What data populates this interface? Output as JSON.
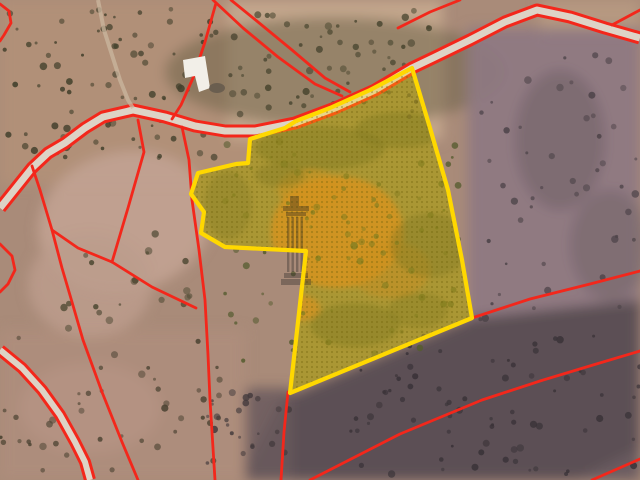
{
  "map": {
    "kind": "satellite-cadastral-map",
    "colors": {
      "parcel_stroke": "#ffd800",
      "parcel_fill": "rgba(255,214,0,0.30)",
      "parcel_dot_texture": "rgba(110,100,10,0.38)",
      "boundary_red": "#f3271b",
      "road_fill": "#ddd3c6",
      "dirt_orange": "#c1762e",
      "terrain_base": "#a98b79",
      "building_white": "#f2efe8"
    },
    "selected_parcel": {
      "points": [
        [
          412,
          68
        ],
        [
          370,
          90
        ],
        [
          330,
          108
        ],
        [
          296,
          121
        ],
        [
          285,
          128
        ],
        [
          250,
          139
        ],
        [
          248,
          163
        ],
        [
          236,
          164
        ],
        [
          198,
          173
        ],
        [
          191,
          194
        ],
        [
          204,
          212
        ],
        [
          201,
          233
        ],
        [
          225,
          247
        ],
        [
          306,
          251
        ],
        [
          290,
          393
        ],
        [
          472,
          318
        ],
        [
          462,
          260
        ],
        [
          448,
          190
        ],
        [
          430,
          128
        ]
      ]
    },
    "boundaries": [
      {
        "points": [
          [
            0,
            4
          ],
          [
            9,
            11
          ],
          [
            11,
            23
          ],
          [
            4,
            35
          ],
          [
            0,
            41
          ]
        ]
      },
      {
        "points": [
          [
            213,
            0
          ],
          [
            243,
            28
          ],
          [
            278,
            57
          ],
          [
            315,
            84
          ],
          [
            342,
            96
          ]
        ]
      },
      {
        "points": [
          [
            231,
            0
          ],
          [
            258,
            22
          ],
          [
            292,
            50
          ],
          [
            325,
            78
          ],
          [
            350,
            92
          ]
        ]
      },
      {
        "points": [
          [
            216,
            3
          ],
          [
            205,
            42
          ],
          [
            193,
            78
          ],
          [
            181,
            105
          ],
          [
            172,
            119
          ]
        ]
      },
      {
        "points": [
          [
            398,
            28
          ],
          [
            430,
            12
          ],
          [
            460,
            0
          ]
        ]
      },
      {
        "points": [
          [
            612,
            25
          ],
          [
            640,
            10
          ]
        ]
      },
      {
        "points": [
          [
            138,
            120
          ],
          [
            144,
            152
          ],
          [
            128,
            208
          ],
          [
            112,
            262
          ]
        ]
      },
      {
        "points": [
          [
            32,
            166
          ],
          [
            40,
            190
          ],
          [
            52,
            230
          ],
          [
            78,
            248
          ],
          [
            112,
            262
          ]
        ]
      },
      {
        "points": [
          [
            52,
            230
          ],
          [
            62,
            268
          ],
          [
            72,
            302
          ],
          [
            83,
            340
          ],
          [
            102,
            392
          ],
          [
            122,
            442
          ],
          [
            138,
            480
          ]
        ]
      },
      {
        "points": [
          [
            112,
            262
          ],
          [
            152,
            287
          ],
          [
            196,
            308
          ]
        ]
      },
      {
        "points": [
          [
            182,
            127
          ],
          [
            189,
            160
          ],
          [
            192,
            200
          ],
          [
            199,
            250
          ],
          [
            205,
            300
          ],
          [
            208,
            355
          ],
          [
            210,
            400
          ],
          [
            215,
            480
          ]
        ]
      },
      {
        "points": [
          [
            288,
            392
          ],
          [
            284,
            432
          ],
          [
            281,
            480
          ]
        ]
      },
      {
        "points": [
          [
            472,
            318
          ],
          [
            530,
            299
          ],
          [
            590,
            284
          ],
          [
            640,
            271
          ]
        ]
      },
      {
        "points": [
          [
            310,
            480
          ],
          [
            400,
            434
          ],
          [
            482,
            400
          ],
          [
            540,
            381
          ],
          [
            593,
            365
          ],
          [
            640,
            351
          ]
        ]
      },
      {
        "points": [
          [
            592,
            480
          ],
          [
            640,
            459
          ]
        ]
      },
      {
        "points": [
          [
            0,
            244
          ],
          [
            12,
            256
          ],
          [
            15,
            270
          ],
          [
            8,
            284
          ],
          [
            0,
            292
          ]
        ]
      }
    ],
    "roads": [
      {
        "width": 7,
        "points": [
          [
            0,
            208
          ],
          [
            8,
            198
          ],
          [
            20,
            183
          ],
          [
            32,
            168
          ],
          [
            48,
            153
          ],
          [
            65,
            143
          ],
          [
            85,
            128
          ],
          [
            103,
            117
          ],
          [
            133,
            110
          ],
          [
            165,
            117
          ],
          [
            195,
            126
          ],
          [
            225,
            131
          ],
          [
            255,
            131
          ],
          [
            295,
            123
          ],
          [
            335,
            108
          ],
          [
            375,
            90
          ],
          [
            412,
            68
          ],
          [
            435,
            57
          ],
          [
            470,
            40
          ],
          [
            505,
            22
          ],
          [
            537,
            10
          ],
          [
            570,
            17
          ],
          [
            605,
            28
          ],
          [
            640,
            38
          ]
        ]
      },
      {
        "width": 6,
        "points": [
          [
            0,
            350
          ],
          [
            22,
            368
          ],
          [
            42,
            390
          ],
          [
            60,
            415
          ],
          [
            75,
            442
          ],
          [
            85,
            462
          ],
          [
            90,
            480
          ]
        ]
      }
    ],
    "tracks": [
      {
        "width": 4,
        "points": [
          [
            98,
            0
          ],
          [
            104,
            30
          ],
          [
            112,
            55
          ],
          [
            120,
            80
          ],
          [
            128,
            100
          ],
          [
            133,
            108
          ]
        ]
      }
    ],
    "building": {
      "points": [
        [
          183,
          60
        ],
        [
          205,
          56
        ],
        [
          210,
          88
        ],
        [
          199,
          92
        ],
        [
          195,
          76
        ],
        [
          185,
          78
        ]
      ]
    },
    "watermark": {
      "icon": "column-watermark-icon"
    }
  }
}
